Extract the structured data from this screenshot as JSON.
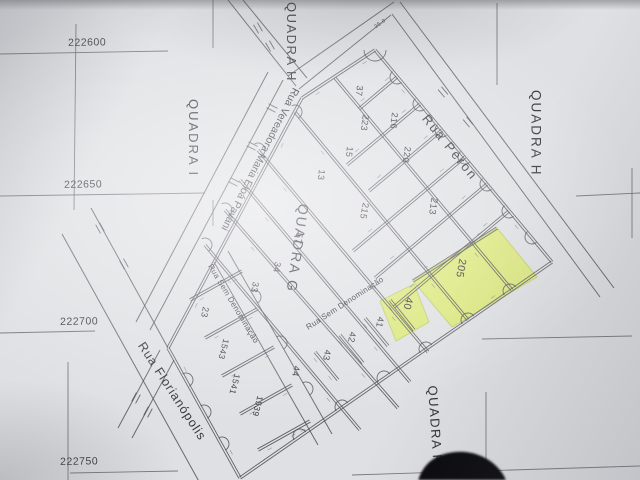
{
  "title": "Cadastral plat photo - Quadra G subdivision",
  "grid_labels": [
    "222600",
    "222650",
    "222700",
    "222750"
  ],
  "quadras": {
    "i": "QUADRA I",
    "h_top": "QUADRA H",
    "h_right": "QUADRA H",
    "g": "QUADRA G",
    "f": "QUADRA F"
  },
  "streets": {
    "peron": "Rua Peron",
    "vereadora": "Rua Vereadora Maria Eloá Pavani",
    "florianopolis": "Rua Florianópolis",
    "sem_denominacao_1": "Rua Sem Denominação",
    "sem_denominacao_2": "Rua Sem Denominação"
  },
  "lots": [
    "37",
    "223",
    "216",
    "220",
    "15",
    "13",
    "215",
    "213",
    "205",
    "57",
    "34",
    "33",
    "23",
    "1543",
    "1541",
    "1539",
    "44",
    "43",
    "42",
    "41",
    "40"
  ],
  "highlighted_lot_numbers": [
    "205",
    "40"
  ],
  "apex_dimension": "35.0",
  "colors": {
    "highlight": "#dbe95f",
    "ink": "#4a4a52",
    "paper": "#dfe0e3"
  }
}
